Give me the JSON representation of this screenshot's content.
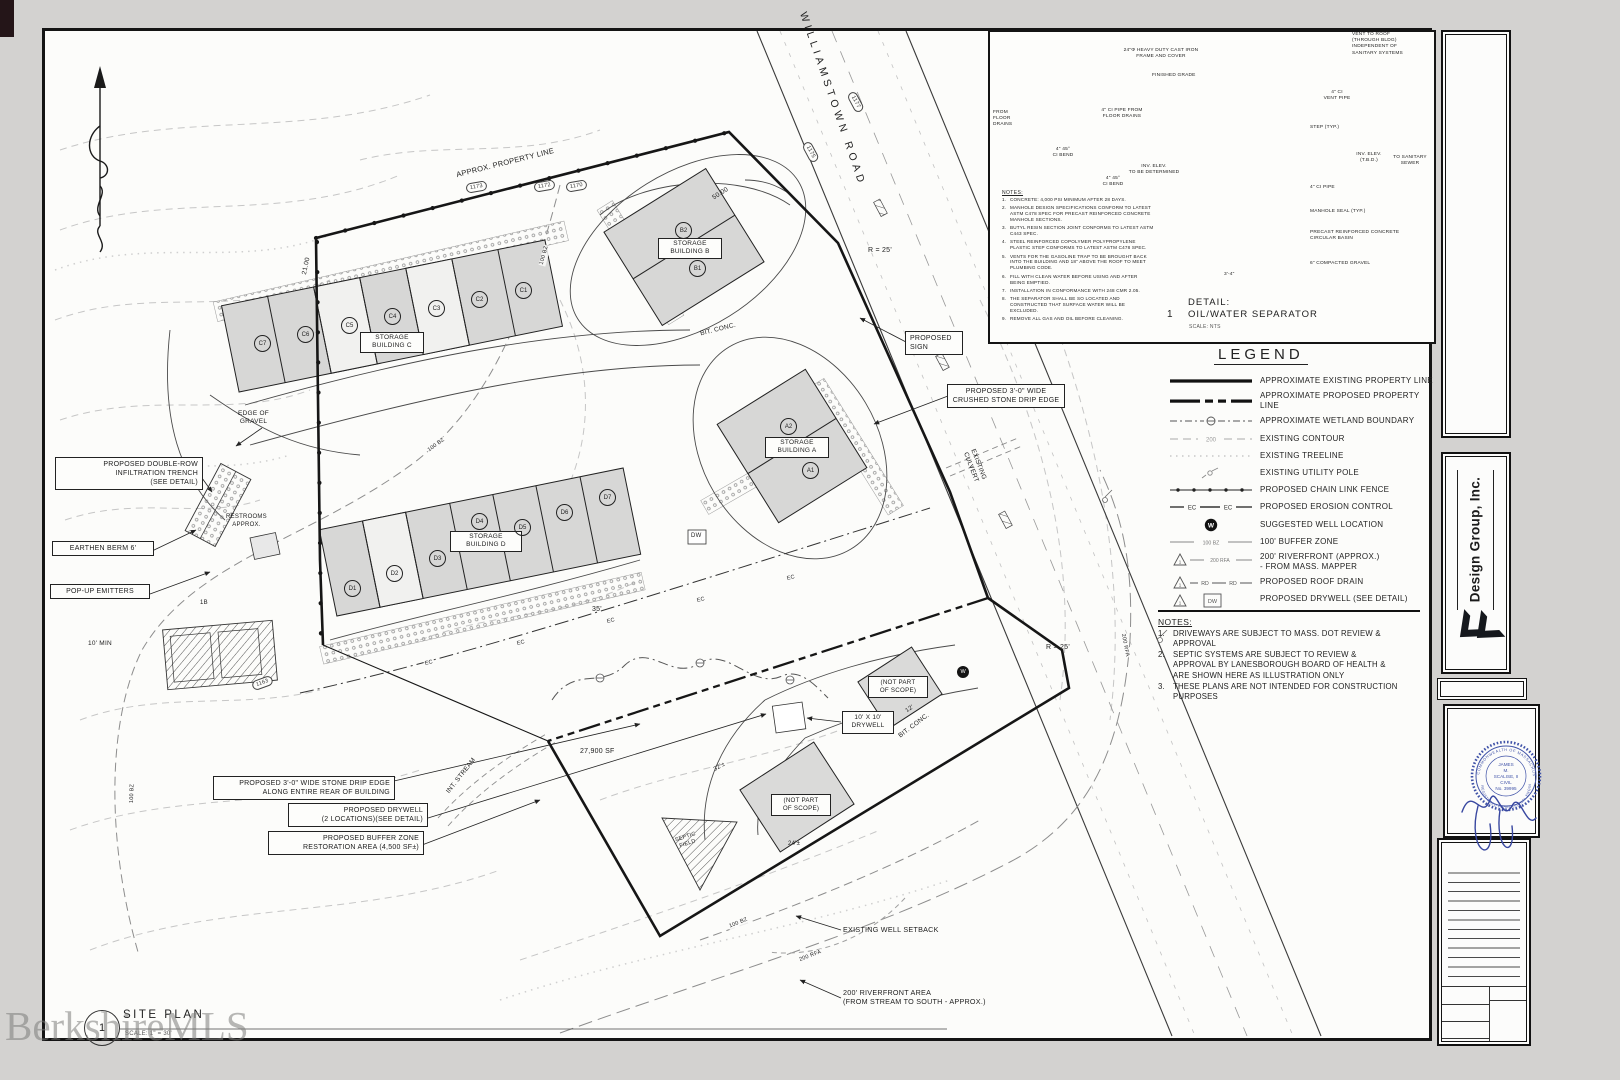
{
  "page": {
    "watermark": "BerkshireMLS"
  },
  "plan": {
    "title": {
      "num": "1",
      "label": "SITE PLAN",
      "scale": "SCALE: 1\" = 30'"
    },
    "road_label": "WILLIAMSTOWN ROAD",
    "property_line_label": "APPROX. PROPERTY LINE",
    "buildings": {
      "a": "STORAGE\nBUILDING A",
      "b": "STORAGE\nBUILDING B",
      "c": "STORAGE\nBUILDING C",
      "d": "STORAGE\nBUILDING D"
    },
    "units": {
      "a": [
        "A2",
        "A1"
      ],
      "b": [
        "B2",
        "B1"
      ],
      "c": [
        "C1",
        "C2",
        "C3",
        "C4",
        "C5",
        "C6",
        "C7"
      ],
      "d": [
        "D1",
        "D2",
        "D3",
        "D4",
        "D5",
        "D6",
        "D7"
      ]
    },
    "callouts": {
      "infiltration": "PROPOSED DOUBLE-ROW\nINFILTRATION TRENCH\n(SEE DETAIL)",
      "berm": "EARTHEN BERM 6'",
      "emitters": "POP-UP EMITTERS",
      "drip_rear": "PROPOSED 3'-0\" WIDE STONE DRIP EDGE\nALONG ENTIRE REAR OF BUILDING",
      "drywell_two": "PROPOSED DRYWELL\n(2 LOCATIONS)(SEE DETAIL)",
      "buffer_restoration": "PROPOSED BUFFER ZONE\nRESTORATION AREA (4,500 SF±)",
      "sign": "PROPOSED\nSIGN",
      "drip_crushed": "PROPOSED 3'-0\" WIDE\nCRUSHED STONE DRIP EDGE",
      "drywell_10": "10' X 10'\nDRYWELL",
      "not_in_scope": "(NOT PART\nOF SCOPE)"
    },
    "labels": {
      "r25": "R = 25'",
      "dim50": "50.00",
      "dim21": "21.00",
      "dim35": "35'",
      "dim32": "32'±",
      "dim24": "24'±",
      "dim12": "12'",
      "min10": "10' MIN",
      "edge_gravel": "EDGE OF\nGRAVEL",
      "restrooms": "RESTROOMS\nAPPROX.",
      "culvert": "EXISTING\nCULVERT",
      "bit_conc": "BIT. CONC.",
      "dw": "DW",
      "w": "W",
      "stream": "INT. STREAM",
      "area_sf": "27,900 SF",
      "septic": "SEPTIC\nFIELD",
      "tag_1b": "1B",
      "ec": "EC",
      "bz": "100 BZ",
      "rfa": "200 RFA",
      "well_setback": "EXISTING WELL SETBACK",
      "riverfront": "200' RIVERFRONT AREA\n(FROM STREAM TO SOUTH - APPROX.)"
    },
    "contour_tags": [
      "1173",
      "1172",
      "1170",
      "1177",
      "1175",
      "1163"
    ]
  },
  "detail": {
    "num": "1",
    "title": "DETAIL:",
    "subtitle": "OIL/WATER SEPARATOR",
    "scale": "SCALE: NTS",
    "labels": {
      "cover": "24\"Φ HEAVY DUTY CAST IRON\nFRAME AND COVER",
      "vent_roof": "VENT TO ROOF\n(THROUGH BLDG)\nINDEPENDENT OF\nSANITARY SYSTEMS",
      "grade": "FINISHED GRADE",
      "from_drains": "FROM\nFLOOR\nDRAINS",
      "pipe_from": "4\" CI PIPE FROM\nFLOOR DRAINS",
      "bend": "4\" 45°\nCI BEND",
      "vent_pipe": "4\" CI\nVENT PIPE",
      "step": "STEP (TYP.)",
      "inv_tbd": "INV. ELEV.\nTO BE DETERMINED",
      "inv2": "INV. ELEV.\n(T.B.D.)",
      "sewer": "TO SANITARY\nSEWER",
      "pipe4": "4\" CI PIPE",
      "seal": "MANHOLE SEAL (TYP.)",
      "basin": "PRECAST REINFORCED CONCRETE\nCIRCULAR BASIN",
      "gravel": "6\" COMPACTED GRAVEL",
      "dim": "3'-4\""
    },
    "notes_title": "NOTES:",
    "notes": [
      {
        "n": "1.",
        "text": "CONCRETE: 4,000 PSI MINIMUM AFTER 28 DAYS."
      },
      {
        "n": "2.",
        "text": "MANHOLE DESIGN SPECIFICATIONS CONFORM TO LATEST ASTM C478 SPEC FOR PRECAST REINFORCED CONCRETE MANHOLE SECTIONS."
      },
      {
        "n": "3.",
        "text": "BUTYL RESIN SECTION JOINT CONFORMS TO LATEST ASTM C443 SPEC."
      },
      {
        "n": "4.",
        "text": "STEEL REINFORCED COPOLYMER POLYPROPYLENE PLASTIC STEP CONFORMS TO LATEST ASTM C478 SPEC."
      },
      {
        "n": "5.",
        "text": "VENTS FOR THE GASOLINE TRAP TO BE BROUGHT BACK INTO THE BUILDING AND 18\" ABOVE THE ROOF TO MEET PLUMBING CODE."
      },
      {
        "n": "6.",
        "text": "FILL WITH CLEAN WATER BEFORE USING AND AFTER BEING EMPTIED."
      },
      {
        "n": "7.",
        "text": "INSTALLATION IN CONFORMANCE WITH 248 CMR 2.05."
      },
      {
        "n": "8.",
        "text": "THE SEPARATOR SHALL BE SO LOCATED AND CONSTRUCTED THAT SURFACE WATER WILL BE EXCLUDED."
      },
      {
        "n": "9.",
        "text": "REMOVE ALL GAS AND OIL BEFORE CLEANING."
      }
    ]
  },
  "legend": {
    "title": "LEGEND",
    "items": [
      {
        "label": "APPROXIMATE EXISTING PROPERTY LINE"
      },
      {
        "label": "APPROXIMATE PROPOSED PROPERTY LINE"
      },
      {
        "label": "APPROXIMATE WETLAND BOUNDARY"
      },
      {
        "label": "EXISTING CONTOUR",
        "sym_text": "200"
      },
      {
        "label": "EXISTING TREELINE"
      },
      {
        "label": "EXISTING UTILITY POLE"
      },
      {
        "label": "PROPOSED CHAIN LINK FENCE"
      },
      {
        "label": "PROPOSED EROSION CONTROL",
        "sym_text": "EC"
      },
      {
        "label": "SUGGESTED WELL LOCATION",
        "sym_text": "W"
      },
      {
        "label": "100' BUFFER ZONE",
        "sym_text": "100 BZ"
      },
      {
        "label": "200' RIVERFRONT (APPROX.)\n- FROM MASS. MAPPER",
        "sym_text": "200 RFA",
        "tri": "1"
      },
      {
        "label": "PROPOSED ROOF DRAIN",
        "sym_text": "RD",
        "tri": "1"
      },
      {
        "label": "PROPOSED DRYWELL (SEE DETAIL)",
        "sym_text": "DW",
        "tri": "1"
      }
    ]
  },
  "notes": {
    "title": "NOTES:",
    "items": [
      {
        "n": "1.",
        "text": "DRIVEWAYS ARE SUBJECT TO MASS. DOT REVIEW & APPROVAL"
      },
      {
        "n": "2.",
        "text": "SEPTIC SYSTEMS ARE SUBJECT TO REVIEW & APPROVAL BY LANESBOROUGH BOARD OF HEALTH & ARE SHOWN HERE AS ILLUSTRATION ONLY"
      },
      {
        "n": "3.",
        "text": "THESE PLANS ARE NOT INTENDED FOR CONSTRUCTION PURPOSES"
      }
    ]
  },
  "titleblock": {
    "company": "Design Group, Inc.",
    "seal": {
      "ring_top": "COMMONWEALTH OF MASSACHUSETTS",
      "ring_bottom": "REGISTERED PROFESSIONAL ENGINEER",
      "center": [
        "JAMES",
        "M.",
        "SCALISE, II",
        "CIVIL",
        "No. 39995"
      ]
    }
  }
}
